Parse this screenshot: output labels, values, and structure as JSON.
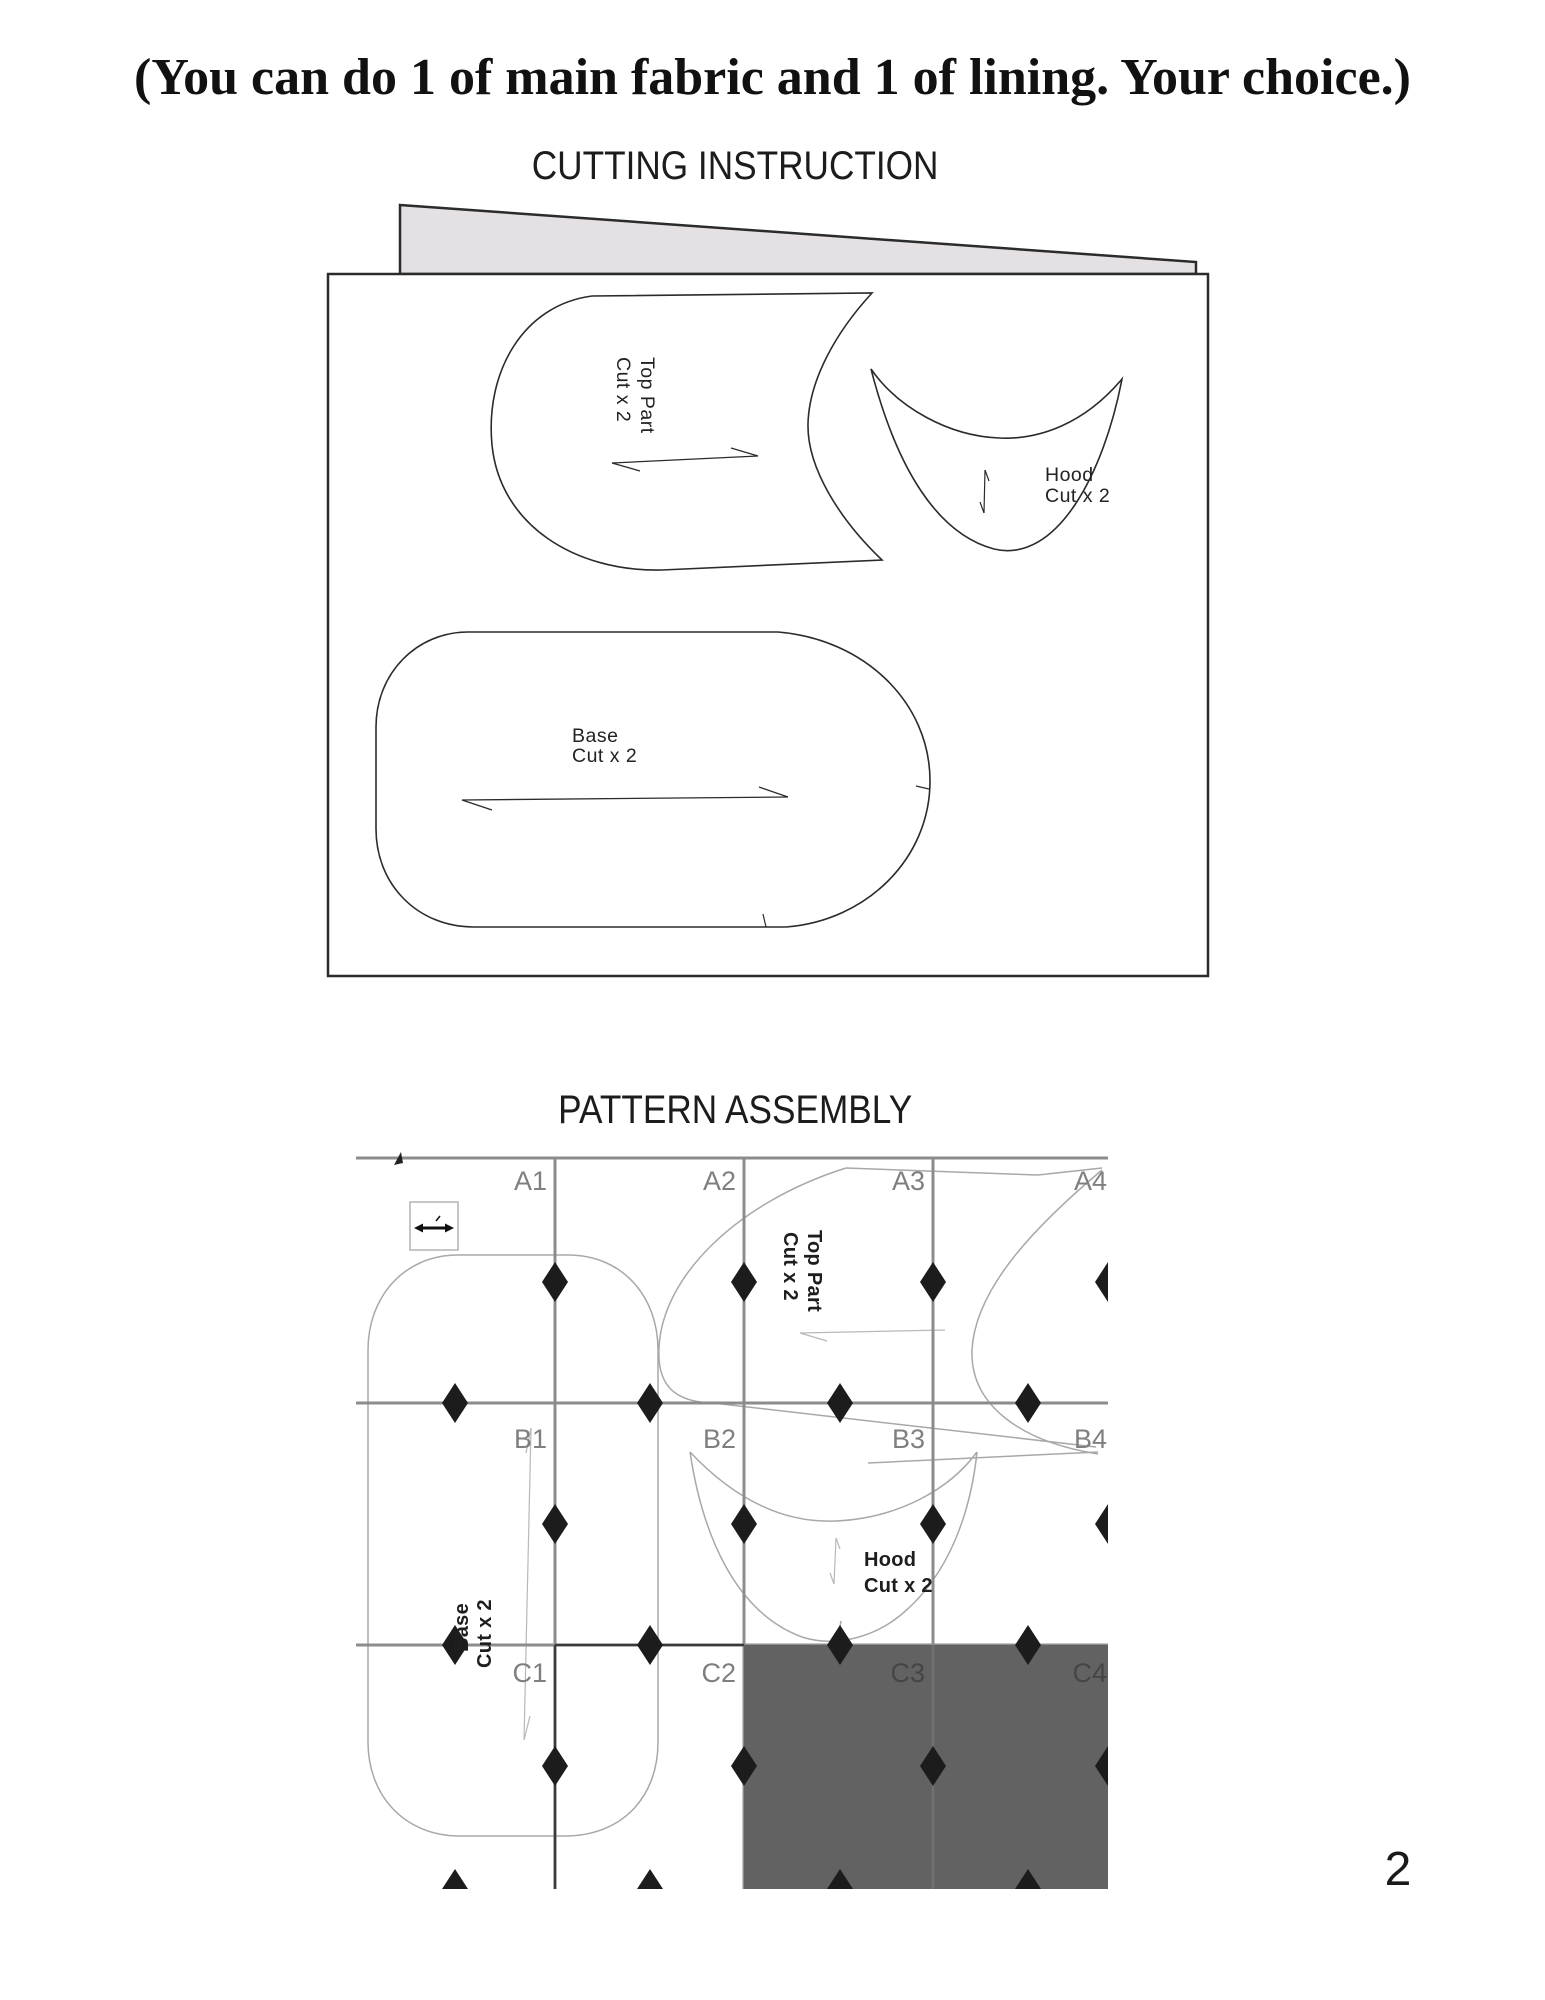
{
  "page": {
    "title": "(You can do 1 of main fabric and 1 of lining. Your choice.)",
    "page_number": "2"
  },
  "cutting": {
    "heading": "CUTTING INSTRUCTION",
    "top_part_name": "Top Part",
    "top_part_qty": "Cut x 2",
    "hood_name": "Hood",
    "hood_qty": "Cut x 2",
    "base_name": "Base",
    "base_qty": "Cut x 2"
  },
  "assembly": {
    "heading": "PATTERN ASSEMBLY",
    "labels": {
      "a": [
        "A1",
        "A2",
        "A3",
        "A4"
      ],
      "b": [
        "B1",
        "B2",
        "B3",
        "B4"
      ],
      "c": [
        "C1",
        "C2",
        "C3",
        "C4"
      ]
    },
    "top_part_name": "Top Part",
    "top_part_qty": "Cut x 2",
    "hood_name": "Hood",
    "hood_qty": "Cut x 2",
    "base_name": "Base",
    "base_qty": "Cut x 2",
    "shaded_block_color": "#626262"
  }
}
